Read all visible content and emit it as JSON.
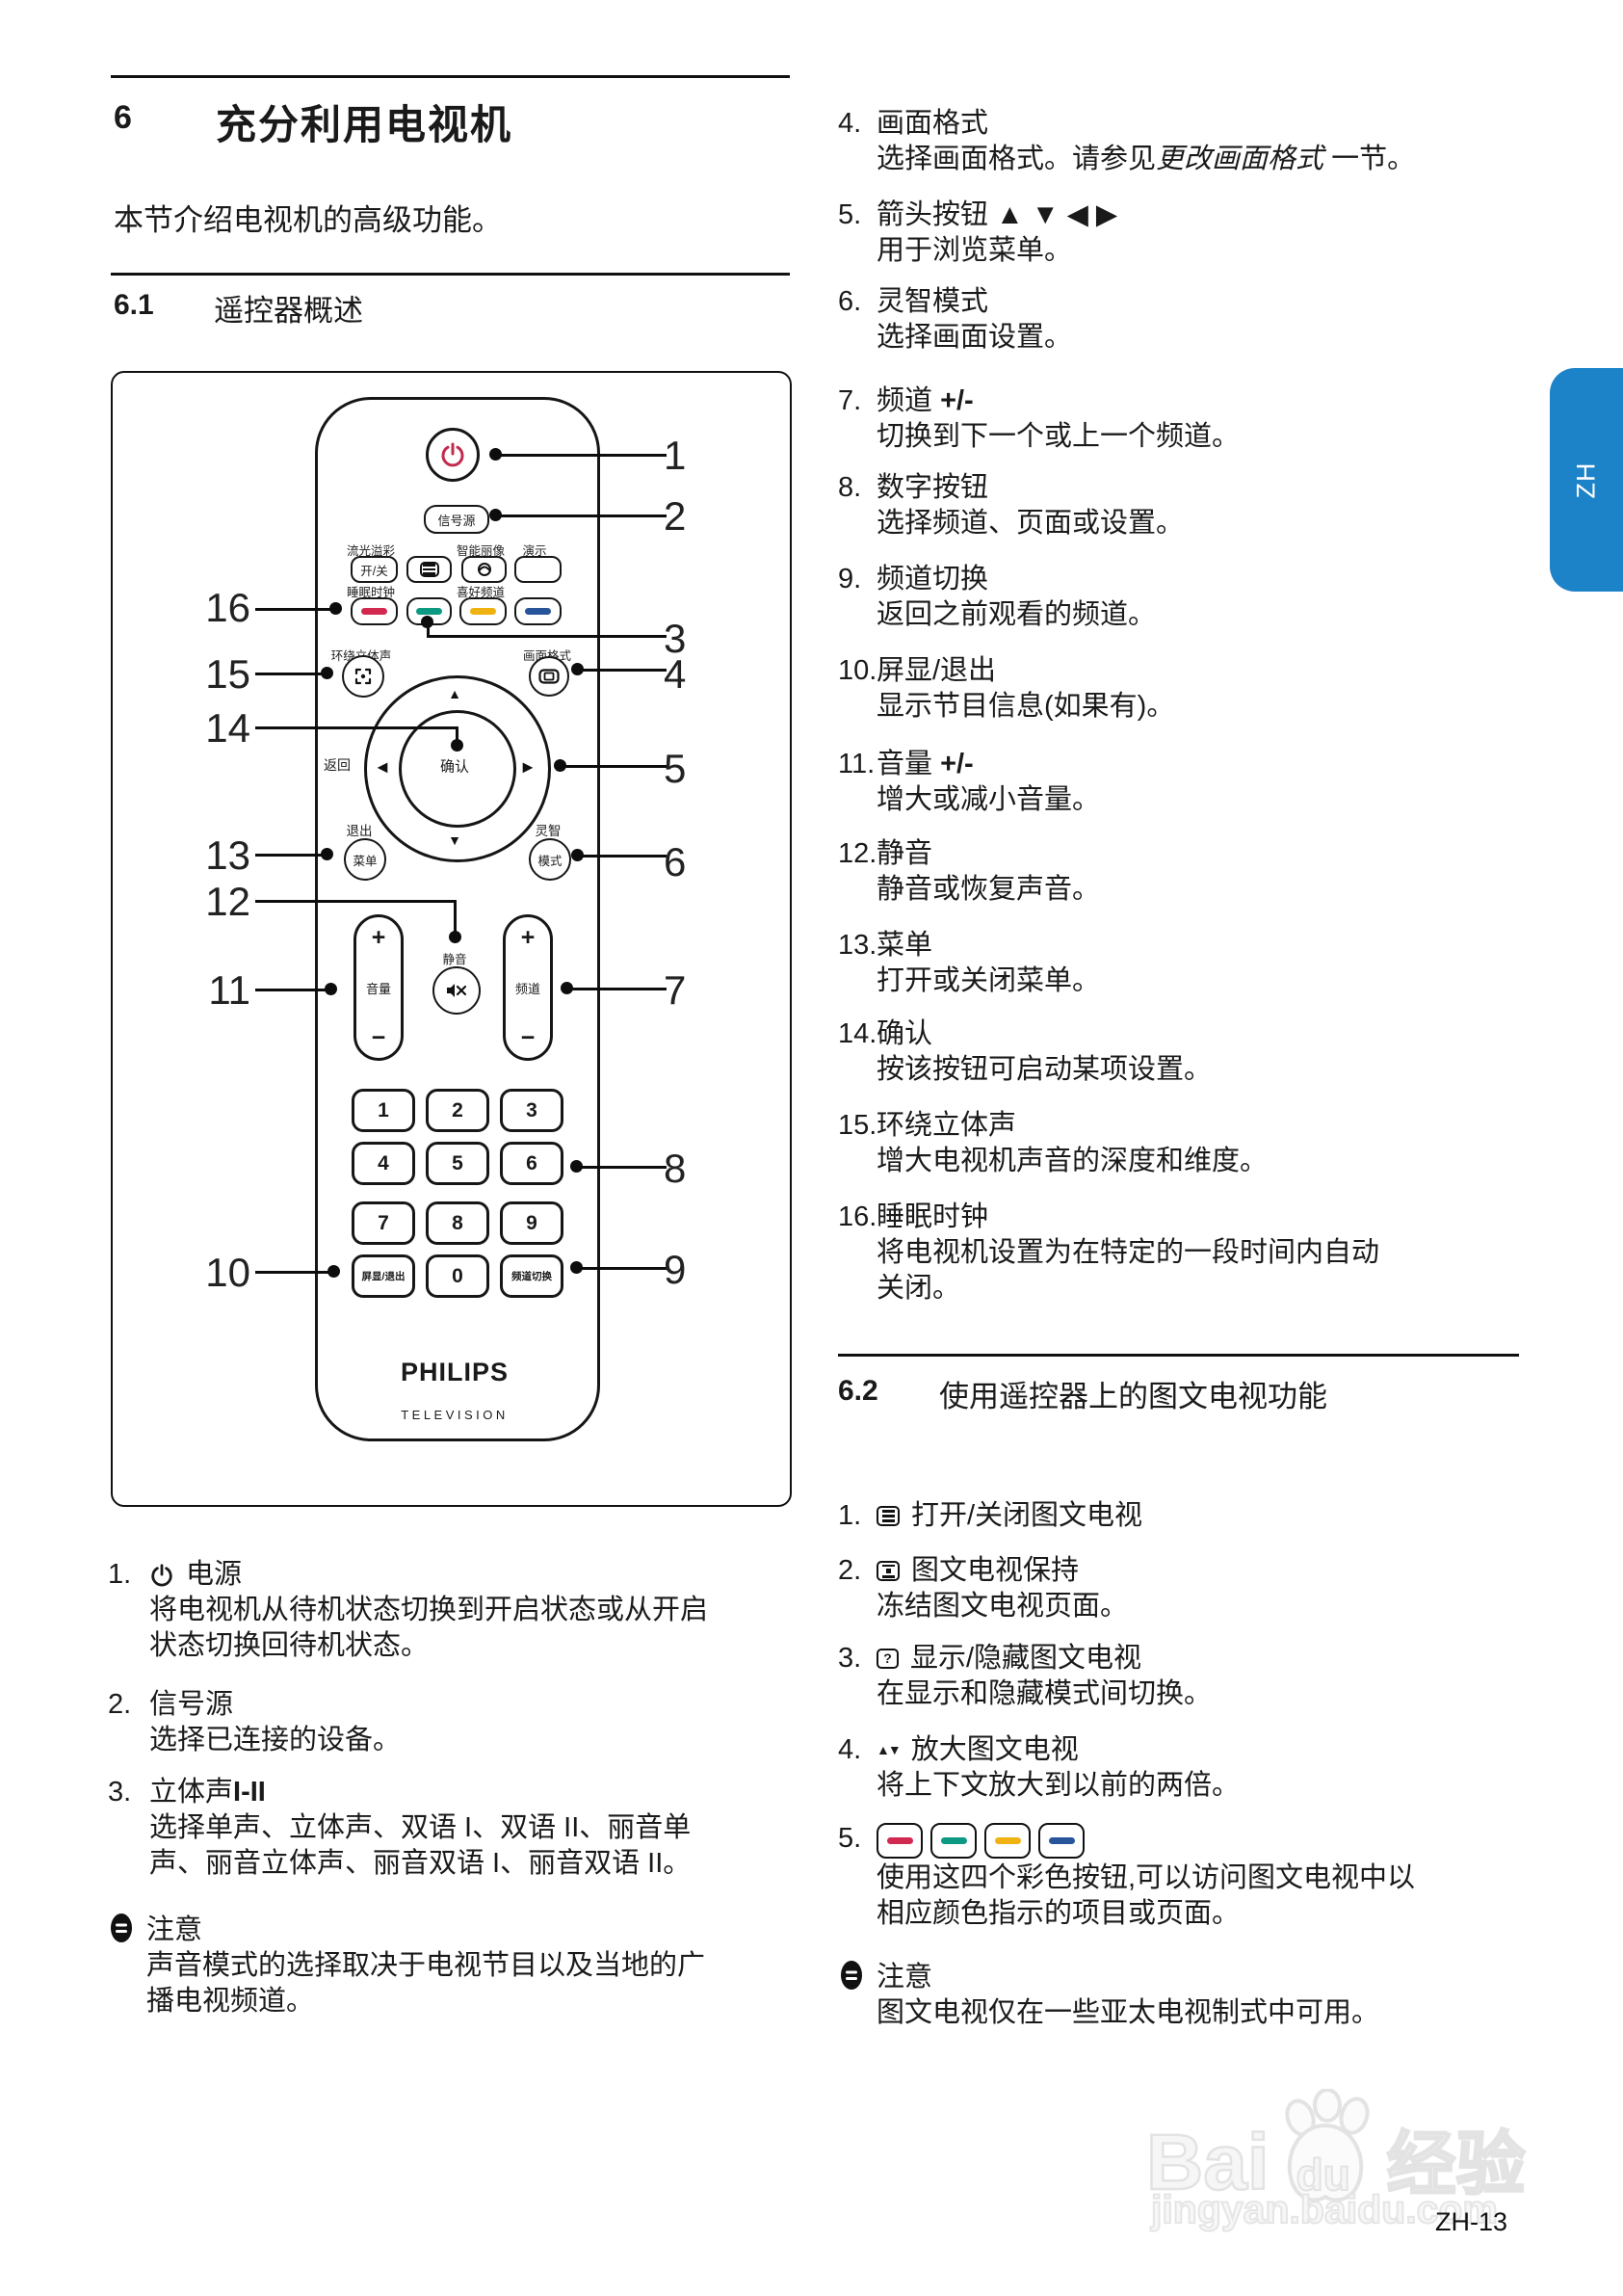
{
  "page": {
    "tab": "ZH",
    "page_number": "ZH-13",
    "accent_blue": "#1d83c9",
    "watermark": {
      "part1": "Bai",
      "part2": "du",
      "part3": "经验",
      "url": "jingyan.baidu.com"
    }
  },
  "section6": {
    "number": "6",
    "title": "充分利用电视机",
    "intro": "本节介绍电视机的高级功能。"
  },
  "section61": {
    "number": "6.1",
    "title": "遥控器概述"
  },
  "section62": {
    "number": "6.2",
    "title": "使用遥控器上的图文电视功能"
  },
  "remote": {
    "source_button": "信号源",
    "ambilight_label": "流光溢彩",
    "ambilight_button": "开/关",
    "smart_picture_label": "智能丽像",
    "demo_label": "演示",
    "sleep_label": "睡眠时钟",
    "favorite_label": "喜好频道",
    "surround_label": "环绕立体声",
    "picture_format_label": "画面格式",
    "back_label": "返回",
    "ok_button": "确认",
    "exit_label": "退出",
    "menu_button": "菜单",
    "smart_label": "灵智",
    "mode_button": "模式",
    "volume_label": "音量",
    "mute_label": "静音",
    "channel_label": "频道",
    "plus": "+",
    "minus": "−",
    "arrow_up": "▲",
    "arrow_down": "▼",
    "arrow_left": "◀",
    "arrow_right": "▶",
    "digits": [
      "1",
      "2",
      "3",
      "4",
      "5",
      "6",
      "7",
      "8",
      "9",
      "0"
    ],
    "osd_button": "屏显/退出",
    "swap_button": "频道切换",
    "brand": "PHILIPS",
    "brand_sub": "TELEVISION",
    "colors": {
      "red": "#d22950",
      "green": "#0e9a82",
      "yellow": "#f0b211",
      "blue": "#27549b"
    },
    "callouts_right": [
      "1",
      "2",
      "3",
      "4",
      "5",
      "6",
      "7",
      "8",
      "9"
    ],
    "callouts_left": [
      "16",
      "15",
      "14",
      "13",
      "12",
      "11",
      "10"
    ]
  },
  "list_left": [
    {
      "num": "1.",
      "heading": "电源",
      "body": "将电视机从待机状态切换到开启状态或从开启\n状态切换回待机状态。"
    },
    {
      "num": "2.",
      "heading": "信号源",
      "body": "选择已连接的设备。"
    },
    {
      "num": "3.",
      "heading": "立体声",
      "heading_bold": "I-II",
      "body": "选择单声、立体声、双语 I、双语 II、丽音单\n声、丽音立体声、丽音双语 I、丽音双语 II。"
    }
  ],
  "note_left": {
    "title": "注意",
    "body": "声音模式的选择取决于电视节目以及当地的广\n播电视频道。"
  },
  "list_right": [
    {
      "num": "4.",
      "heading": "画面格式",
      "body_prefix": "选择画面格式。请参见",
      "body_italic": "更改画面格式",
      "body_suffix": " 一节。"
    },
    {
      "num": "5.",
      "heading": "箭头按钮 ▲ ▼ ◀ ▶",
      "body": "用于浏览菜单。"
    },
    {
      "num": "6.",
      "heading": "灵智模式",
      "body": "选择画面设置。"
    },
    {
      "num": "7.",
      "heading": "频道 ",
      "heading_bold": "+/-",
      "body": "切换到下一个或上一个频道。"
    },
    {
      "num": "8.",
      "heading": "数字按钮",
      "body": "选择频道、页面或设置。"
    },
    {
      "num": "9.",
      "heading": "频道切换",
      "body": "返回之前观看的频道。"
    },
    {
      "num": "10.",
      "heading": "屏显/退出",
      "body": "显示节目信息(如果有)。"
    },
    {
      "num": "11.",
      "heading": "音量 ",
      "heading_bold": "+/-",
      "body": "增大或减小音量。"
    },
    {
      "num": "12.",
      "heading": "静音",
      "body": "静音或恢复声音。"
    },
    {
      "num": "13.",
      "heading": "菜单",
      "body": "打开或关闭菜单。"
    },
    {
      "num": "14.",
      "heading": "确认",
      "body": "按该按钮可启动某项设置。"
    },
    {
      "num": "15.",
      "heading": "环绕立体声",
      "body": "增大电视机声音的深度和维度。"
    },
    {
      "num": "16.",
      "heading": "睡眠时钟",
      "body": "将电视机设置为在特定的一段时间内自动\n关闭。"
    }
  ],
  "list62": [
    {
      "num": "1.",
      "heading": "打开/关闭图文电视"
    },
    {
      "num": "2.",
      "heading": "图文电视保持",
      "body": "冻结图文电视页面。"
    },
    {
      "num": "3.",
      "heading": "显示/隐藏图文电视",
      "body": "在显示和隐藏模式间切换。"
    },
    {
      "num": "4.",
      "heading": "放大图文电视",
      "body": "将上下文放大到以前的两倍。"
    },
    {
      "num": "5.",
      "body": "使用这四个彩色按钮,可以访问图文电视中以\n相应颜色指示的项目或页面。"
    }
  ],
  "note62": {
    "title": "注意",
    "body": "图文电视仅在一些亚太电视制式中可用。"
  }
}
